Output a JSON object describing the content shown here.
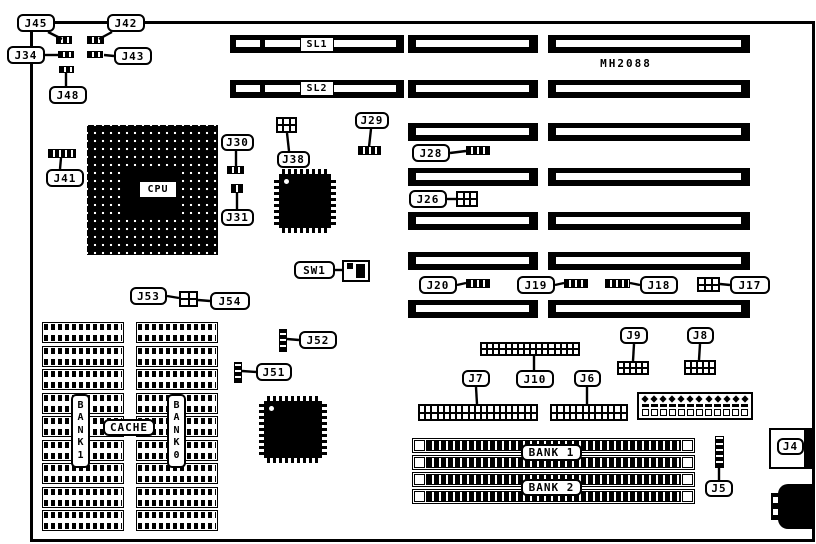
{
  "model_number": "MH2088",
  "colors": {
    "ink": "#000000",
    "paper": "#ffffff"
  },
  "board": {
    "x": 30,
    "y": 21,
    "w": 779,
    "h": 515
  },
  "callouts": [
    {
      "name": "j45",
      "text": "J45",
      "x": 17,
      "y": 14,
      "w": 38,
      "h": 18,
      "style": "callout"
    },
    {
      "name": "j42",
      "text": "J42",
      "x": 107,
      "y": 14,
      "w": 38,
      "h": 18,
      "style": "callout"
    },
    {
      "name": "j34",
      "text": "J34",
      "x": 7,
      "y": 46,
      "w": 38,
      "h": 18,
      "style": "callout"
    },
    {
      "name": "j43",
      "text": "J43",
      "x": 114,
      "y": 47,
      "w": 38,
      "h": 18,
      "style": "callout"
    },
    {
      "name": "j48",
      "text": "J48",
      "x": 49,
      "y": 86,
      "w": 38,
      "h": 18,
      "style": "callout"
    },
    {
      "name": "j41",
      "text": "J41",
      "x": 46,
      "y": 169,
      "w": 38,
      "h": 18,
      "style": "callout"
    },
    {
      "name": "j30",
      "text": "J30",
      "x": 221,
      "y": 134,
      "w": 33,
      "h": 17,
      "style": "callout"
    },
    {
      "name": "j31",
      "text": "J31",
      "x": 221,
      "y": 209,
      "w": 33,
      "h": 17,
      "style": "callout"
    },
    {
      "name": "j38",
      "text": "J38",
      "x": 277,
      "y": 151,
      "w": 33,
      "h": 17,
      "style": "callout"
    },
    {
      "name": "j29",
      "text": "J29",
      "x": 355,
      "y": 112,
      "w": 34,
      "h": 17,
      "style": "callout"
    },
    {
      "name": "j28",
      "text": "J28",
      "x": 412,
      "y": 144,
      "w": 38,
      "h": 18,
      "style": "callout"
    },
    {
      "name": "j26",
      "text": "J26",
      "x": 409,
      "y": 190,
      "w": 38,
      "h": 18,
      "style": "callout"
    },
    {
      "name": "sw1",
      "text": "SW1",
      "x": 294,
      "y": 261,
      "w": 41,
      "h": 18,
      "style": "callout"
    },
    {
      "name": "j53",
      "text": "J53",
      "x": 130,
      "y": 287,
      "w": 37,
      "h": 18,
      "style": "callout"
    },
    {
      "name": "j54",
      "text": "J54",
      "x": 210,
      "y": 292,
      "w": 40,
      "h": 18,
      "style": "callout"
    },
    {
      "name": "j20",
      "text": "J20",
      "x": 419,
      "y": 276,
      "w": 38,
      "h": 18,
      "style": "callout"
    },
    {
      "name": "j19",
      "text": "J19",
      "x": 517,
      "y": 276,
      "w": 38,
      "h": 18,
      "style": "callout"
    },
    {
      "name": "j18",
      "text": "J18",
      "x": 640,
      "y": 276,
      "w": 38,
      "h": 18,
      "style": "callout"
    },
    {
      "name": "j17",
      "text": "J17",
      "x": 730,
      "y": 276,
      "w": 40,
      "h": 18,
      "style": "callout"
    },
    {
      "name": "j52",
      "text": "J52",
      "x": 299,
      "y": 331,
      "w": 38,
      "h": 18,
      "style": "callout"
    },
    {
      "name": "j51",
      "text": "J51",
      "x": 256,
      "y": 363,
      "w": 36,
      "h": 18,
      "style": "callout"
    },
    {
      "name": "j9",
      "text": "J9",
      "x": 620,
      "y": 327,
      "w": 28,
      "h": 17,
      "style": "callout"
    },
    {
      "name": "j8",
      "text": "J8",
      "x": 687,
      "y": 327,
      "w": 27,
      "h": 17,
      "style": "callout"
    },
    {
      "name": "j7",
      "text": "J7",
      "x": 462,
      "y": 370,
      "w": 28,
      "h": 17,
      "style": "callout"
    },
    {
      "name": "j10",
      "text": "J10",
      "x": 516,
      "y": 370,
      "w": 38,
      "h": 18,
      "style": "callout"
    },
    {
      "name": "j6",
      "text": "J6",
      "x": 574,
      "y": 370,
      "w": 27,
      "h": 17,
      "style": "callout"
    },
    {
      "name": "j5",
      "text": "J5",
      "x": 705,
      "y": 480,
      "w": 28,
      "h": 17,
      "style": "callout"
    },
    {
      "name": "j4",
      "text": "J4",
      "x": 777,
      "y": 438,
      "w": 27,
      "h": 17,
      "style": "callout"
    },
    {
      "name": "sl1",
      "text": "SL1",
      "x": 300,
      "y": 37,
      "w": 34,
      "h": 15,
      "style": "plain"
    },
    {
      "name": "sl2",
      "text": "SL2",
      "x": 300,
      "y": 81,
      "w": 34,
      "h": 15,
      "style": "plain"
    },
    {
      "name": "cpu",
      "text": "CPU",
      "x": 139,
      "y": 181,
      "w": 38,
      "h": 17,
      "style": "plain"
    },
    {
      "name": "cache",
      "text": "CACHE",
      "x": 103,
      "y": 419,
      "w": 52,
      "h": 17,
      "style": "callout"
    },
    {
      "name": "bank1-cache",
      "text": "B\nA\nN\nK\n1",
      "x": 71,
      "y": 394,
      "w": 19,
      "h": 74,
      "style": "vertical"
    },
    {
      "name": "bank0-cache",
      "text": "B\nA\nN\nK\n0",
      "x": 167,
      "y": 394,
      "w": 19,
      "h": 74,
      "style": "vertical"
    },
    {
      "name": "bank1-simm",
      "text": "BANK 1",
      "x": 521,
      "y": 444,
      "w": 61,
      "h": 17,
      "style": "callout"
    },
    {
      "name": "bank2-simm",
      "text": "BANK 2",
      "x": 521,
      "y": 479,
      "w": 61,
      "h": 17,
      "style": "callout"
    },
    {
      "name": "model-number",
      "text": "MH2088",
      "x": 595,
      "y": 56,
      "w": 62,
      "h": 14,
      "style": "text"
    }
  ],
  "leaders": [
    [
      48,
      32,
      62,
      39
    ],
    [
      112,
      32,
      99,
      39
    ],
    [
      44,
      55,
      58,
      55
    ],
    [
      114,
      56,
      104,
      55
    ],
    [
      66,
      86,
      66,
      73
    ],
    [
      60,
      169,
      61,
      158
    ],
    [
      236,
      151,
      236,
      166
    ],
    [
      237,
      209,
      237,
      193
    ],
    [
      289,
      151,
      287,
      133
    ],
    [
      371,
      129,
      369,
      147
    ],
    [
      450,
      153,
      466,
      151
    ],
    [
      447,
      199,
      456,
      199
    ],
    [
      335,
      270,
      342,
      270
    ],
    [
      167,
      296,
      179,
      298
    ],
    [
      210,
      301,
      198,
      300
    ],
    [
      457,
      285,
      466,
      283
    ],
    [
      555,
      285,
      564,
      283
    ],
    [
      640,
      285,
      630,
      283
    ],
    [
      730,
      285,
      720,
      284
    ],
    [
      299,
      340,
      287,
      339
    ],
    [
      256,
      372,
      242,
      371
    ],
    [
      634,
      344,
      633,
      361
    ],
    [
      700,
      344,
      699,
      360
    ],
    [
      476,
      387,
      477,
      404
    ],
    [
      534,
      370,
      534,
      356
    ],
    [
      587,
      387,
      587,
      404
    ],
    [
      719,
      480,
      719,
      468
    ]
  ],
  "slots": [
    {
      "name": "slot-sl1",
      "x": 230,
      "y": 35,
      "w": 174,
      "kind": "sl"
    },
    {
      "name": "slot-sl2",
      "x": 230,
      "y": 80,
      "w": 174,
      "kind": "sl"
    },
    {
      "name": "slot-mid-1",
      "x": 408,
      "y": 35,
      "w": 130,
      "kind": "std"
    },
    {
      "name": "slot-mid-2",
      "x": 408,
      "y": 80,
      "w": 130,
      "kind": "std"
    },
    {
      "name": "slot-mid-3",
      "x": 408,
      "y": 123,
      "w": 130,
      "kind": "std"
    },
    {
      "name": "slot-mid-4",
      "x": 408,
      "y": 168,
      "w": 130,
      "kind": "std"
    },
    {
      "name": "slot-mid-5",
      "x": 408,
      "y": 212,
      "w": 130,
      "kind": "std"
    },
    {
      "name": "slot-mid-6",
      "x": 408,
      "y": 252,
      "w": 130,
      "kind": "std"
    },
    {
      "name": "slot-mid-7",
      "x": 408,
      "y": 300,
      "w": 130,
      "kind": "std"
    },
    {
      "name": "slot-right-1",
      "x": 548,
      "y": 35,
      "w": 202,
      "kind": "std"
    },
    {
      "name": "slot-right-2",
      "x": 548,
      "y": 80,
      "w": 202,
      "kind": "std"
    },
    {
      "name": "slot-right-3",
      "x": 548,
      "y": 123,
      "w": 202,
      "kind": "std"
    },
    {
      "name": "slot-right-4",
      "x": 548,
      "y": 168,
      "w": 202,
      "kind": "std"
    },
    {
      "name": "slot-right-5",
      "x": 548,
      "y": 212,
      "w": 202,
      "kind": "std"
    },
    {
      "name": "slot-right-6",
      "x": 548,
      "y": 252,
      "w": 202,
      "kind": "std"
    },
    {
      "name": "slot-right-7",
      "x": 548,
      "y": 300,
      "w": 202,
      "kind": "std"
    }
  ],
  "jumpers_h": [
    {
      "name": "jumper-j45",
      "x": 56,
      "y": 36,
      "w": 16,
      "h": 8
    },
    {
      "name": "jumper-j42",
      "x": 87,
      "y": 36,
      "w": 17,
      "h": 8
    },
    {
      "name": "jumper-j34",
      "x": 58,
      "y": 51,
      "w": 16,
      "h": 7
    },
    {
      "name": "jumper-j43",
      "x": 87,
      "y": 51,
      "w": 16,
      "h": 7
    },
    {
      "name": "jumper-j48",
      "x": 59,
      "y": 66,
      "w": 15,
      "h": 7
    },
    {
      "name": "jumper-j41",
      "x": 48,
      "y": 149,
      "w": 28,
      "h": 9
    },
    {
      "name": "jumper-j30",
      "x": 227,
      "y": 166,
      "w": 17,
      "h": 8
    },
    {
      "name": "jumper-j31",
      "x": 231,
      "y": 184,
      "w": 12,
      "h": 9
    },
    {
      "name": "jumper-j29",
      "x": 358,
      "y": 146,
      "w": 23,
      "h": 9
    },
    {
      "name": "jumper-j28",
      "x": 466,
      "y": 146,
      "w": 24,
      "h": 9
    },
    {
      "name": "jumper-j20",
      "x": 466,
      "y": 279,
      "w": 24,
      "h": 9
    },
    {
      "name": "jumper-j19",
      "x": 564,
      "y": 279,
      "w": 24,
      "h": 9
    },
    {
      "name": "jumper-j18",
      "x": 605,
      "y": 279,
      "w": 25,
      "h": 9
    }
  ],
  "jumpers_v": [
    {
      "name": "jumper-j52",
      "x": 279,
      "y": 329,
      "w": 8,
      "h": 23
    },
    {
      "name": "jumper-j51",
      "x": 234,
      "y": 362,
      "w": 8,
      "h": 21
    },
    {
      "name": "jumper-j5",
      "x": 715,
      "y": 436,
      "w": 9,
      "h": 32
    }
  ],
  "grid_headers": [
    {
      "name": "header-j38",
      "x": 276,
      "y": 117,
      "w": 21,
      "h": 16,
      "cols": 3,
      "rows": 2
    },
    {
      "name": "header-j26",
      "x": 456,
      "y": 191,
      "w": 22,
      "h": 16,
      "cols": 3,
      "rows": 2
    },
    {
      "name": "header-j17",
      "x": 697,
      "y": 277,
      "w": 23,
      "h": 15,
      "cols": 3,
      "rows": 2
    },
    {
      "name": "header-j53-j54",
      "x": 179,
      "y": 291,
      "w": 19,
      "h": 16,
      "cols": 2,
      "rows": 2
    },
    {
      "name": "header-j9",
      "x": 617,
      "y": 361,
      "w": 32,
      "h": 14,
      "cols": 5,
      "rows": 2
    },
    {
      "name": "header-j8",
      "x": 684,
      "y": 360,
      "w": 32,
      "h": 15,
      "cols": 5,
      "rows": 2
    },
    {
      "name": "header-j10",
      "x": 480,
      "y": 342,
      "w": 100,
      "h": 14,
      "cols": 16,
      "rows": 2
    },
    {
      "name": "header-j7",
      "x": 418,
      "y": 404,
      "w": 120,
      "h": 17,
      "cols": 19,
      "rows": 2
    },
    {
      "name": "header-j6",
      "x": 550,
      "y": 404,
      "w": 78,
      "h": 17,
      "cols": 12,
      "rows": 2
    }
  ],
  "cpu_socket": {
    "x": 87,
    "y": 125,
    "w": 131,
    "h": 130
  },
  "qfp_chips": [
    {
      "name": "qfp-chip-upper",
      "x": 274,
      "y": 169,
      "w": 62,
      "h": 64
    },
    {
      "name": "qfp-chip-lower",
      "x": 259,
      "y": 396,
      "w": 68,
      "h": 67
    }
  ],
  "dip_columns": [
    {
      "name": "dip-column-bank1",
      "x": 42,
      "y": 322,
      "w": 82,
      "count": 9,
      "pitch": 23.5,
      "chip_h": 21
    },
    {
      "name": "dip-column-bank0",
      "x": 136,
      "y": 322,
      "w": 82,
      "count": 9,
      "pitch": 23.5,
      "chip_h": 21
    }
  ],
  "simm_sockets": {
    "x": 412,
    "w": 283,
    "h": 15,
    "rows_y": [
      438,
      455,
      472,
      489
    ]
  },
  "power_connector": {
    "x": 637,
    "y": 392,
    "w": 116,
    "h": 28,
    "pins": 12
  },
  "switch_sw1": {
    "x": 342,
    "y": 260,
    "w": 28,
    "h": 22
  },
  "j4_box": {
    "x": 769,
    "y": 428,
    "w": 43,
    "h": 41
  },
  "keyboard_connector": {
    "main": [
      778,
      484,
      35,
      45
    ],
    "tab": [
      771,
      493,
      10,
      27
    ],
    "notches": [
      [
        772,
        496,
        7,
        8
      ],
      [
        772,
        508,
        7,
        8
      ]
    ]
  }
}
